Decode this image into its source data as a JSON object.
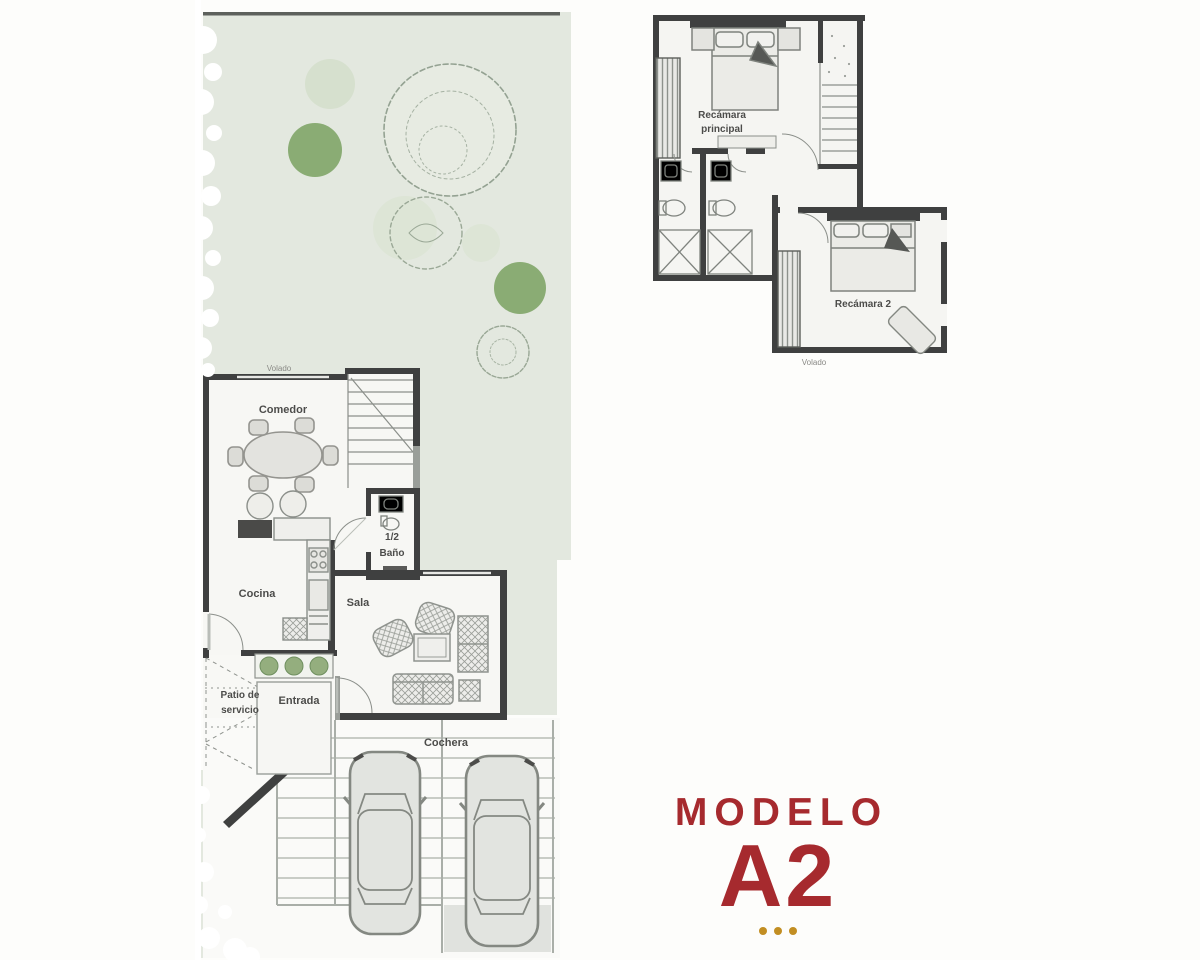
{
  "colors": {
    "accent_red": "#a62a2e",
    "dot_gold": "#c28e22",
    "garden_green": "#e3e8df",
    "bush_green": "#7fa568",
    "wall_dark": "#3f4040"
  },
  "model_block": {
    "label": "MODELO",
    "model": "A2"
  },
  "ground_floor": {
    "labels": {
      "volado": "Volado",
      "comedor": "Comedor",
      "cocina": "Cocina",
      "half_bath_top": "1/2",
      "half_bath_bottom": "Baño",
      "sala": "Sala",
      "patio_line1": "Patio de",
      "patio_line2": "servicio",
      "entrada": "Entrada",
      "cochera": "Cochera"
    }
  },
  "upper_floor": {
    "labels": {
      "recamara_principal_line1": "Recámara",
      "recamara_principal_line2": "principal",
      "recamara_2": "Recámara 2",
      "volado": "Volado"
    }
  }
}
